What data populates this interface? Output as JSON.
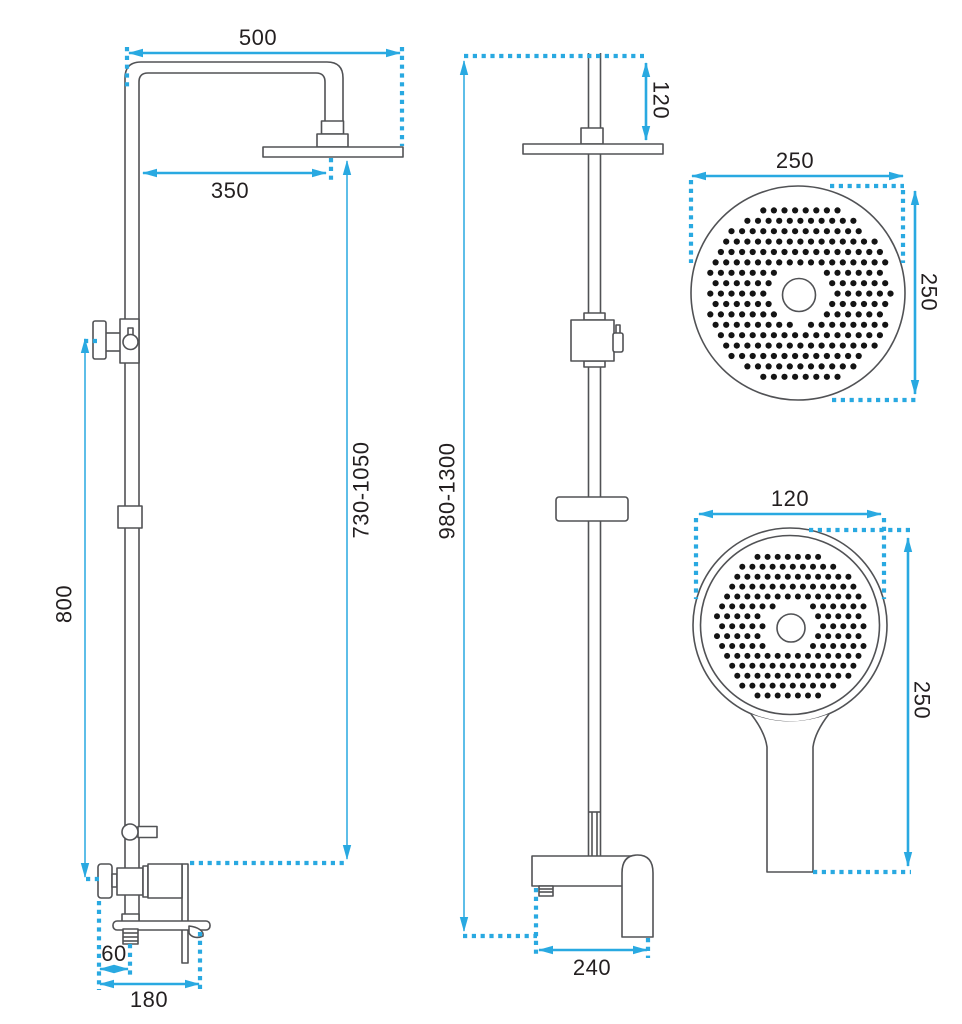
{
  "colors": {
    "dimension": "#29a9e1",
    "outline": "#515255",
    "dots": "#141414",
    "text": "#231f20",
    "background": "#ffffff"
  },
  "views": {
    "front": {
      "label": "shower column front view",
      "dims": {
        "arm_reach": "500",
        "head_offset": "350",
        "column_adjust_range": "730-1050",
        "rail_height": "800",
        "wall_clearance": "60",
        "base_depth": "180"
      }
    },
    "side": {
      "label": "shower column side view",
      "dims": {
        "head_drop": "120",
        "total_height_range": "980-1300",
        "mixer_depth": "240"
      }
    },
    "rainhead": {
      "label": "rain shower head face view",
      "dims": {
        "diameter_h": "250",
        "diameter_v": "250"
      },
      "pattern": {
        "cx": 798,
        "cy": 293,
        "fill_r": 93,
        "sx": 10.6,
        "sy": 10.4,
        "dot_r": 3.1,
        "hole_cx": 799,
        "hole_cy": 295,
        "hole_clear_r": 30
      }
    },
    "handshower": {
      "label": "hand shower face view",
      "dims": {
        "head_width": "120",
        "total_length": "250"
      },
      "pattern": {
        "cx": 790,
        "cy": 625,
        "fill_r": 78,
        "sx": 10.1,
        "sy": 9.9,
        "dot_r": 3.0,
        "hole_cx": 791,
        "hole_cy": 628,
        "hole_clear_r": 27
      }
    }
  }
}
